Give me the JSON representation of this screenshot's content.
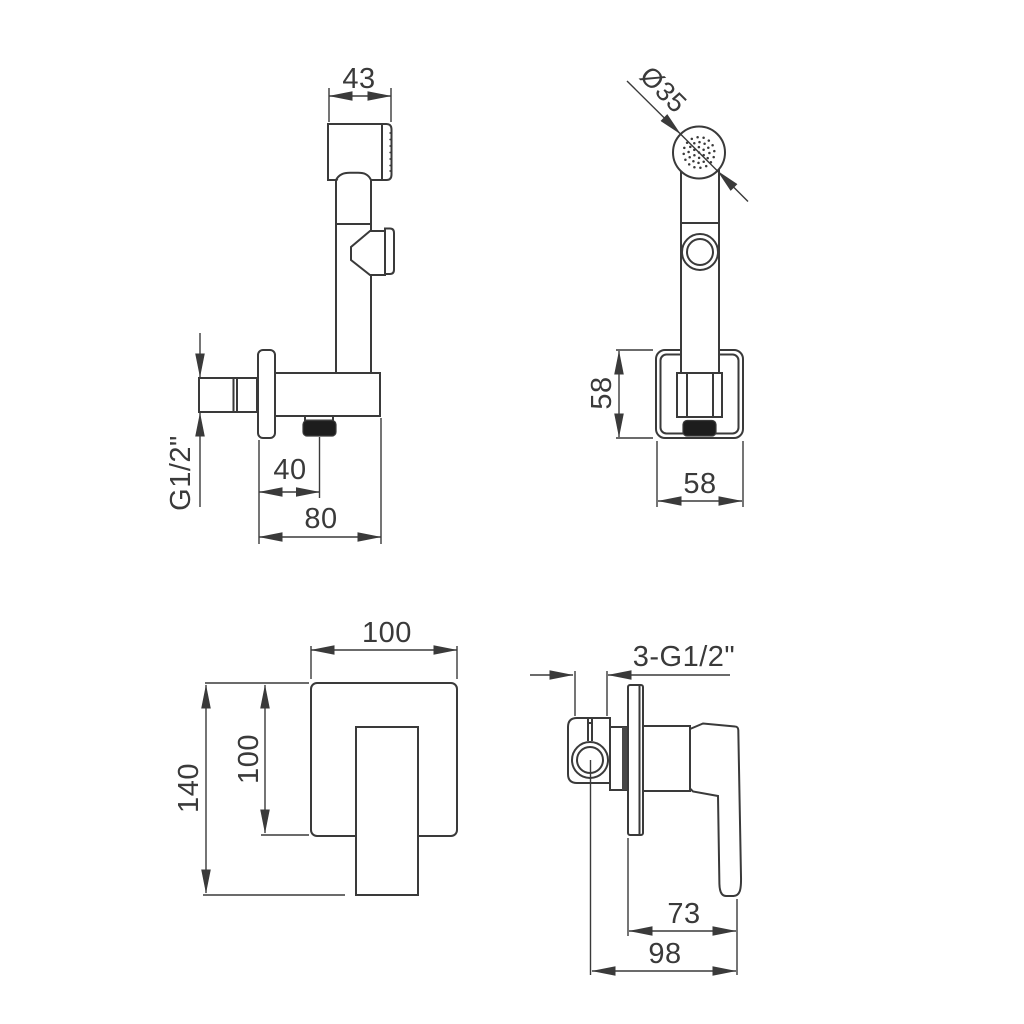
{
  "drawing": {
    "type": "technical-dimension-drawing",
    "product": "concealed bidet hand shower set",
    "units_implied": "mm",
    "style": {
      "line_color": "#3a3a3a",
      "text_color": "#3a3a3a",
      "black_fill": "#1d1d1d",
      "background": "#ffffff"
    },
    "views": {
      "hand_shower_side": {
        "dims": {
          "head_width": "43",
          "inlet_thread": "G1/2\"",
          "hose_outlet_offset": "40",
          "holder_depth": "80"
        }
      },
      "hand_shower_front": {
        "dims": {
          "spray_face_diameter": "Ø35",
          "escutcheon_height": "58",
          "escutcheon_width": "58"
        }
      },
      "mixer_trim_front": {
        "dims": {
          "plate_width": "100",
          "plate_height": "100",
          "overall_height": "140"
        }
      },
      "mixer_valve_side": {
        "dims": {
          "connection_threads": "3-G1/2\"",
          "handle_projection": "73",
          "overall_depth": "98"
        }
      }
    }
  }
}
